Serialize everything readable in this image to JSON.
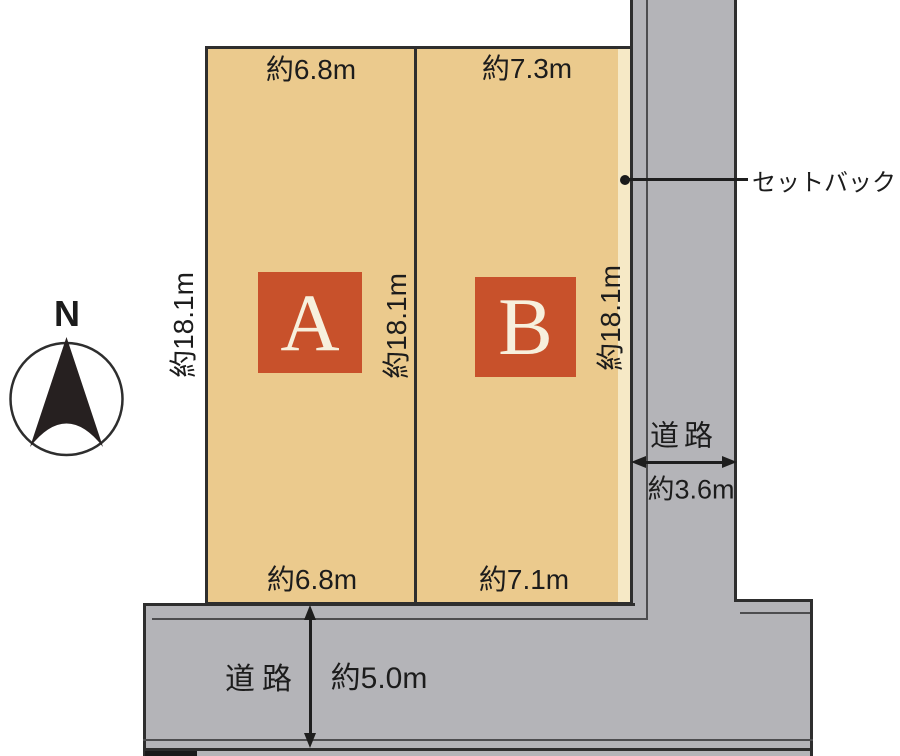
{
  "compass": {
    "north_label": "N"
  },
  "plots": {
    "a": {
      "label": "A",
      "top_width": "約6.8m",
      "bottom_width": "約6.8m",
      "depth_left": "約18.1m",
      "depth_right": "約18.1m"
    },
    "b": {
      "label": "B",
      "top_width": "約7.3m",
      "bottom_width": "約7.1m",
      "depth_right": "約18.1m"
    }
  },
  "annotations": {
    "setback": "セットバック"
  },
  "roads": {
    "east": {
      "label": "道路",
      "width": "約3.6m"
    },
    "south": {
      "label": "道路",
      "width": "約5.0m"
    }
  },
  "colors": {
    "plot_fill": "#ebca8d",
    "setback_strip": "#f6e9c6",
    "road_fill": "#b4b4b8",
    "outline": "#2e2e2e",
    "plot_marker_bg": "#c8512b",
    "plot_marker_text": "#f7f0dd"
  }
}
